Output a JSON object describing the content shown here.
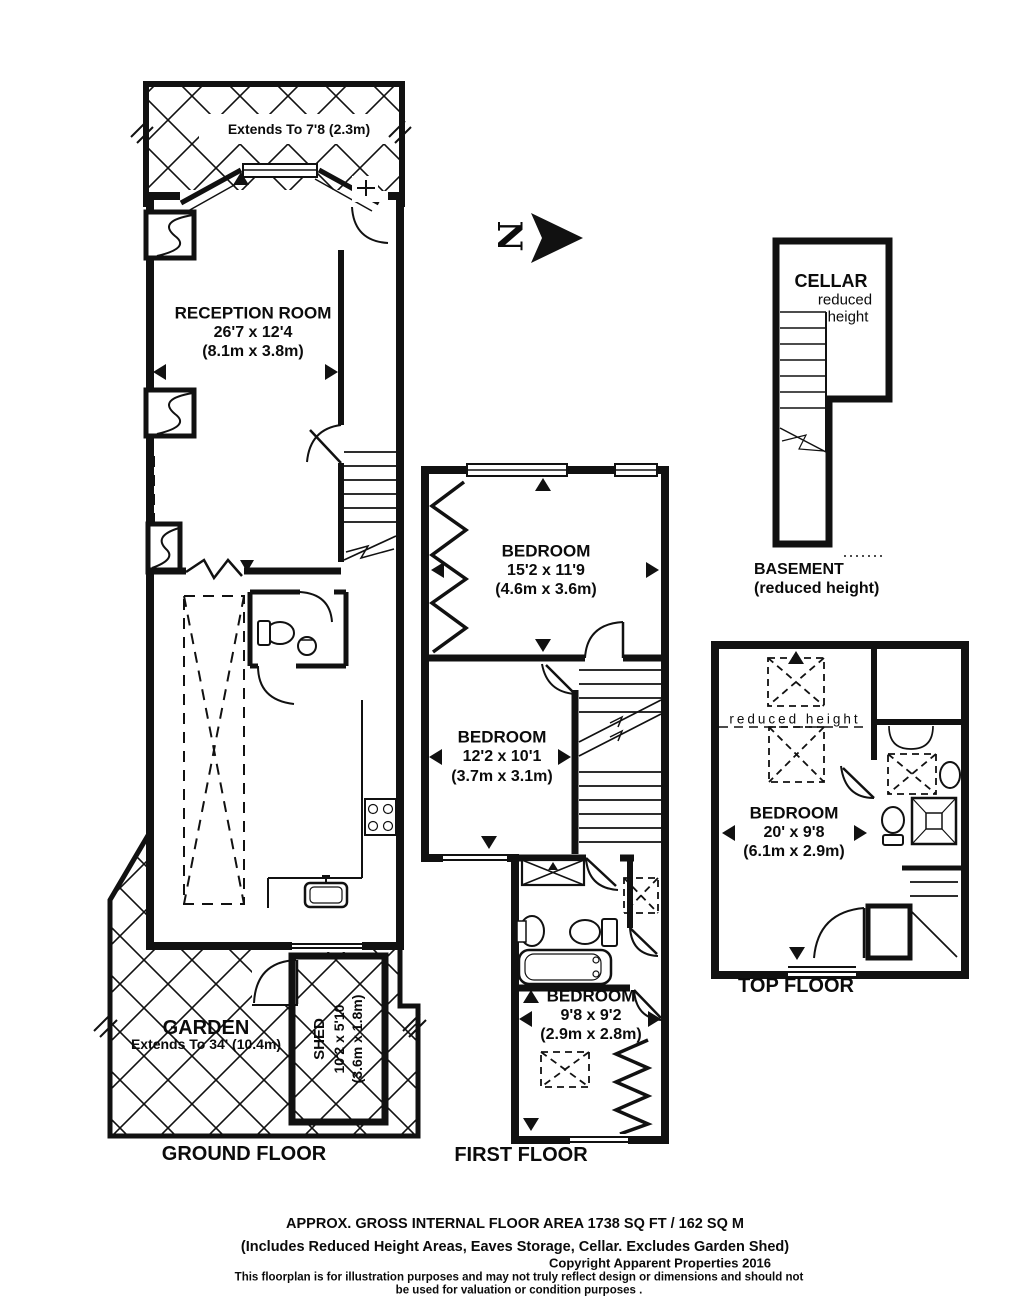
{
  "north": {
    "label": "N"
  },
  "ground_floor": {
    "floor_label": "GROUND FLOOR",
    "bay_note": "Extends To 7'8 (2.3m)",
    "reception": {
      "name": "RECEPTION ROOM",
      "size_imperial": "26'7 x 12'4",
      "size_metric": "(8.1m x 3.8m)"
    },
    "garden": {
      "name": "GARDEN",
      "size_note": "Extends To 34' (10.4m)"
    },
    "shed": {
      "name": "SHED",
      "size_imperial": "10'2 x 5'10",
      "size_metric": "(3.6m x 1.8m)"
    }
  },
  "first_floor": {
    "floor_label": "FIRST FLOOR",
    "bedroom_front": {
      "name": "BEDROOM",
      "size_imperial": "15'2 x 11'9",
      "size_metric": "(4.6m x 3.6m)"
    },
    "bedroom_middle": {
      "name": "BEDROOM",
      "size_imperial": "12'2 x 10'1",
      "size_metric": "(3.7m x 3.1m)"
    },
    "bedroom_back": {
      "name": "BEDROOM",
      "size_imperial": "9'8 x 9'2",
      "size_metric": "(2.9m x 2.8m)"
    }
  },
  "top_floor": {
    "floor_label": "TOP FLOOR",
    "reduced_height_note": "reduced height",
    "bedroom": {
      "name": "BEDROOM",
      "size_imperial": "20' x 9'8",
      "size_metric": "(6.1m x 2.9m)"
    }
  },
  "basement": {
    "floor_label": "BASEMENT",
    "floor_sublabel": "(reduced height)",
    "cellar": {
      "name": "CELLAR",
      "note_line1": "reduced",
      "note_line2": "height"
    }
  },
  "footer": {
    "area_line": "APPROX. GROSS INTERNAL FLOOR AREA 1738 SQ FT / 162 SQ M",
    "includes_line": "(Includes Reduced Height Areas, Eaves Storage, Cellar. Excludes Garden Shed)",
    "copyright_line": "Copyright Apparent Properties 2016",
    "disclaimer_line1": "This floorplan is for illustration purposes and may not truly reflect design or dimensions and should not",
    "disclaimer_line2": "be used for valuation or condition purposes ."
  },
  "colors": {
    "ink": "#111111",
    "paper": "#ffffff"
  }
}
